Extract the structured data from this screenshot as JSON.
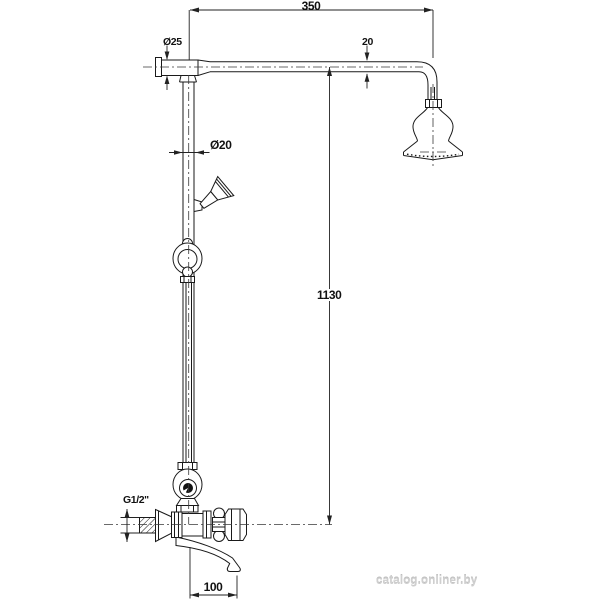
{
  "figure": {
    "type": "technical-dimension-drawing",
    "line_color": "#1a1a1a",
    "dimension_color": "#222222",
    "background": "#ffffff"
  },
  "dimensions": {
    "arm_length": "350",
    "arm_pipe_diameter": "20",
    "wall_connector_diameter": "Ø25",
    "riser_pipe_diameter": "Ø20",
    "column_height": "1130",
    "inlet_thread": "G1/2\"",
    "spout_length": "100"
  },
  "watermark": "catalog.onliner.by"
}
